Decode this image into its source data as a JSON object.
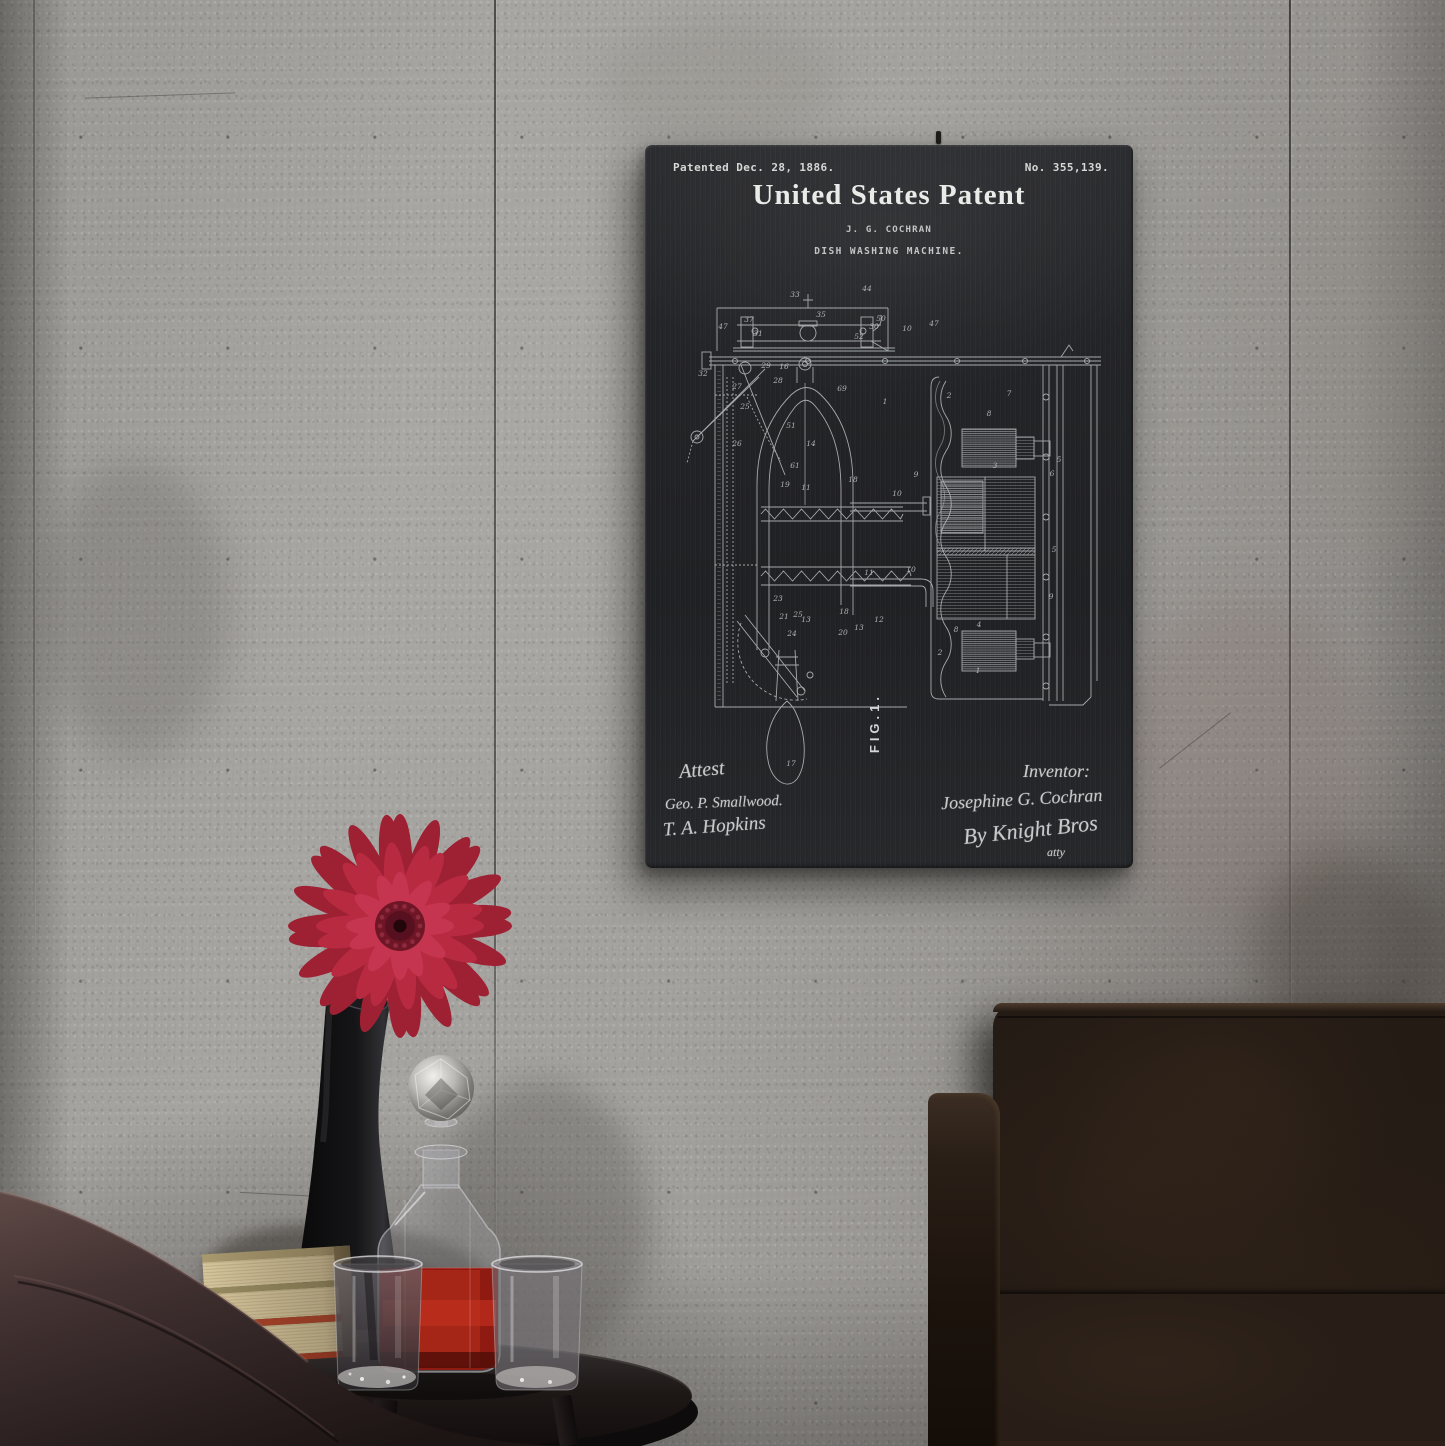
{
  "scene": {
    "setting": "Patent blueprint wall art on a concrete panel wall above a black side table with a red gerbera in a black vase, a crystal decanter of red liquor, two glasses and a stack of books, beside a dark leather pouf and sofa",
    "wall_color": "#a19f9b",
    "poster_surface_color": "#232427",
    "poster_ink_color": "#dfe1e2",
    "flower_colors": {
      "outer": "#9e2033",
      "mid": "#b82a40",
      "inner": "#c63550",
      "center": "#6f1626"
    },
    "liquid_color": "#8e1a12",
    "sofa_color": "#241b15",
    "objects": [
      "patent-wall-art",
      "gerbera-flower",
      "black-vase",
      "crystal-decanter",
      "tumbler-glass",
      "tumbler-glass",
      "book-stack",
      "side-table",
      "leather-pouf",
      "leather-sofa"
    ]
  },
  "artwork": {
    "patented_line": "Patented Dec. 28, 1886.",
    "patent_number": "No. 355,139.",
    "title": "United States Patent",
    "inventor_name": "J. G. COCHRAN",
    "subject": "DISH WASHING MACHINE.",
    "figure_label": "FIG.1.",
    "attest_heading": "Attest",
    "attest_signature_1": "Geo. P. Smallwood.",
    "attest_signature_2": "T. A. Hopkins",
    "inventor_heading": "Inventor:",
    "inventor_signature": "Josephine G. Cochran",
    "by_signature": "By Knight Bros",
    "attorney_note": "atty",
    "drawing_labels": [
      {
        "t": "33",
        "x": 150,
        "y": 152
      },
      {
        "t": "44",
        "x": 222,
        "y": 146
      },
      {
        "t": "47",
        "x": 78,
        "y": 184
      },
      {
        "t": "37",
        "x": 104,
        "y": 177
      },
      {
        "t": "31",
        "x": 113,
        "y": 191
      },
      {
        "t": "35",
        "x": 176,
        "y": 172
      },
      {
        "t": "30",
        "x": 229,
        "y": 184
      },
      {
        "t": "52",
        "x": 214,
        "y": 194
      },
      {
        "t": "50",
        "x": 236,
        "y": 176
      },
      {
        "t": "10",
        "x": 262,
        "y": 186
      },
      {
        "t": "47",
        "x": 289,
        "y": 181
      },
      {
        "t": "16",
        "x": 139,
        "y": 224
      },
      {
        "t": "32",
        "x": 58,
        "y": 231
      },
      {
        "t": "29",
        "x": 121,
        "y": 223
      },
      {
        "t": "28",
        "x": 133,
        "y": 238
      },
      {
        "t": "27",
        "x": 92,
        "y": 244
      },
      {
        "t": "25",
        "x": 100,
        "y": 264
      },
      {
        "t": "26",
        "x": 92,
        "y": 301
      },
      {
        "t": "69",
        "x": 197,
        "y": 246
      },
      {
        "t": "1",
        "x": 240,
        "y": 259
      },
      {
        "t": "2",
        "x": 304,
        "y": 253
      },
      {
        "t": "7",
        "x": 364,
        "y": 251
      },
      {
        "t": "8",
        "x": 344,
        "y": 271
      },
      {
        "t": "3",
        "x": 350,
        "y": 323
      },
      {
        "t": "9",
        "x": 271,
        "y": 332
      },
      {
        "t": "6",
        "x": 407,
        "y": 331
      },
      {
        "t": "5",
        "x": 414,
        "y": 317
      },
      {
        "t": "14",
        "x": 166,
        "y": 301
      },
      {
        "t": "51",
        "x": 146,
        "y": 283
      },
      {
        "t": "19",
        "x": 140,
        "y": 342
      },
      {
        "t": "11",
        "x": 161,
        "y": 345
      },
      {
        "t": "18",
        "x": 208,
        "y": 337
      },
      {
        "t": "10",
        "x": 252,
        "y": 351
      },
      {
        "t": "10",
        "x": 266,
        "y": 427
      },
      {
        "t": "11",
        "x": 224,
        "y": 430
      },
      {
        "t": "23",
        "x": 133,
        "y": 456
      },
      {
        "t": "21",
        "x": 139,
        "y": 474
      },
      {
        "t": "25",
        "x": 153,
        "y": 472
      },
      {
        "t": "13",
        "x": 161,
        "y": 477
      },
      {
        "t": "18",
        "x": 199,
        "y": 469
      },
      {
        "t": "20",
        "x": 198,
        "y": 490
      },
      {
        "t": "13",
        "x": 214,
        "y": 485
      },
      {
        "t": "12",
        "x": 234,
        "y": 477
      },
      {
        "t": "24",
        "x": 147,
        "y": 491
      },
      {
        "t": "4",
        "x": 334,
        "y": 482
      },
      {
        "t": "8",
        "x": 311,
        "y": 487
      },
      {
        "t": "2",
        "x": 295,
        "y": 510
      },
      {
        "t": "1",
        "x": 333,
        "y": 528
      },
      {
        "t": "9",
        "x": 406,
        "y": 454
      },
      {
        "t": "5",
        "x": 409,
        "y": 407
      },
      {
        "t": "61",
        "x": 150,
        "y": 323
      },
      {
        "t": "17",
        "x": 146,
        "y": 621
      }
    ]
  }
}
